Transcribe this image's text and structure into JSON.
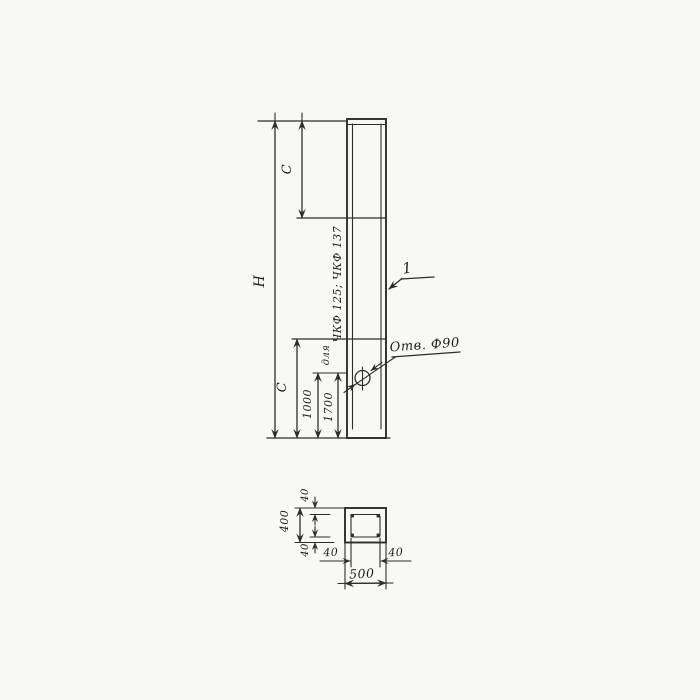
{
  "colors": {
    "ink": "#2e2d2b",
    "paper": "#f8f8f6"
  },
  "elevation": {
    "overall_height_label": "H",
    "upper_segment_label": "C",
    "lower_segment_label": "C",
    "hole_offset_primary": "1000",
    "hole_offset_alternate": "1700",
    "note_prefix": "для",
    "note_products": "ЧКФ 125; ЧКФ 137",
    "hole_callout": "Отв. Ф90",
    "item_mark": "1"
  },
  "section": {
    "overall_width": "500",
    "overall_height": "400",
    "wall_top": "40",
    "wall_bottom": "40",
    "wall_left": "40",
    "wall_right": "40"
  }
}
